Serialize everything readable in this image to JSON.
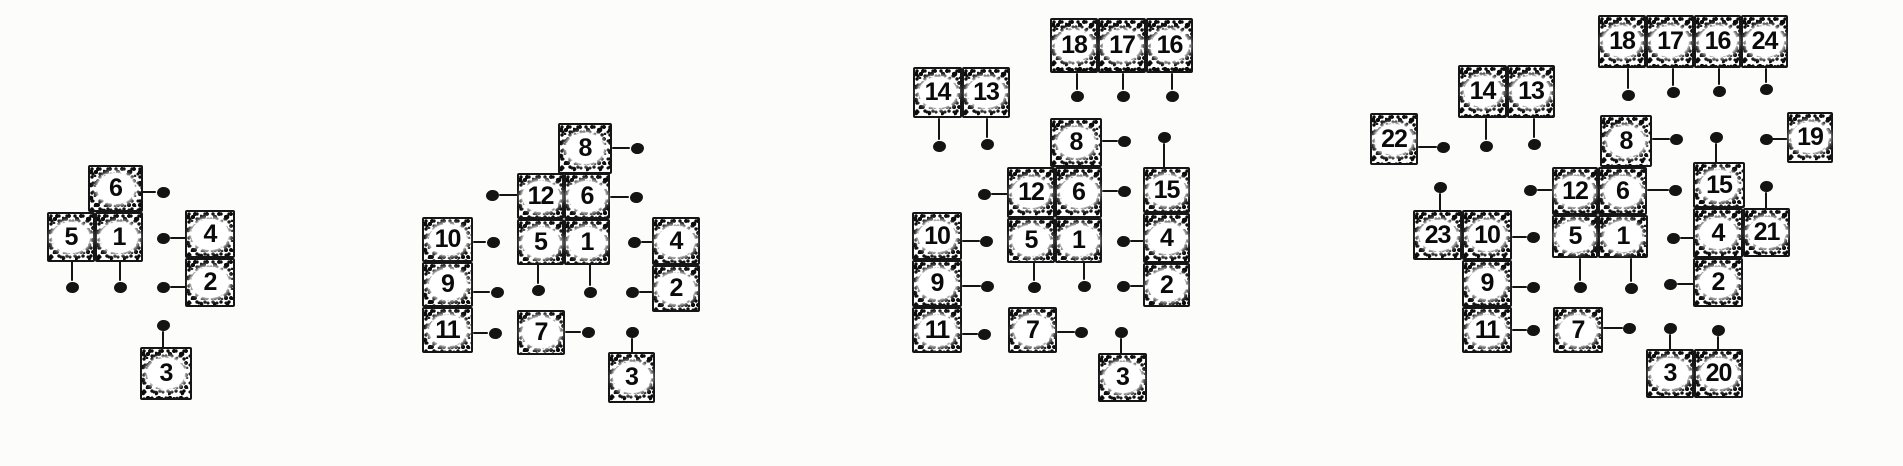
{
  "colors": {
    "ink": "#141414",
    "paper": "#fcfcfb",
    "badge_fill": "#ffffff"
  },
  "panels": [
    {
      "stage": 1,
      "unit_numbers": [
        "1",
        "2",
        "3",
        "4",
        "5",
        "6"
      ],
      "cells": [
        {
          "n": "6",
          "x": 88,
          "y": 165,
          "w": 55,
          "h": 47
        },
        {
          "n": "5",
          "x": 47,
          "y": 212,
          "w": 48,
          "h": 50
        },
        {
          "n": "1",
          "x": 95,
          "y": 212,
          "w": 48,
          "h": 50
        },
        {
          "n": "4",
          "x": 185,
          "y": 210,
          "w": 50,
          "h": 48
        },
        {
          "n": "2",
          "x": 185,
          "y": 258,
          "w": 50,
          "h": 49
        },
        {
          "n": "3",
          "x": 140,
          "y": 347,
          "w": 52,
          "h": 53
        }
      ],
      "dots": [
        {
          "x": 163,
          "y": 192
        },
        {
          "x": 163,
          "y": 238
        },
        {
          "x": 72,
          "y": 287
        },
        {
          "x": 120,
          "y": 287
        },
        {
          "x": 163,
          "y": 287
        },
        {
          "x": 163,
          "y": 325
        }
      ],
      "lines": [
        {
          "x1": 141,
          "y1": 192,
          "x2": 156,
          "y2": 192
        },
        {
          "x1": 170,
          "y1": 238,
          "x2": 187,
          "y2": 238
        },
        {
          "x1": 72,
          "y1": 256,
          "x2": 72,
          "y2": 281
        },
        {
          "x1": 120,
          "y1": 256,
          "x2": 120,
          "y2": 281
        },
        {
          "x1": 170,
          "y1": 287,
          "x2": 187,
          "y2": 287
        },
        {
          "x1": 163,
          "y1": 331,
          "x2": 163,
          "y2": 349
        }
      ]
    },
    {
      "stage": 2,
      "unit_numbers": [
        "1",
        "2",
        "3",
        "4",
        "5",
        "6",
        "7",
        "8",
        "9",
        "10",
        "11",
        "12"
      ],
      "cells": [
        {
          "n": "8",
          "x": 558,
          "y": 123,
          "w": 54,
          "h": 51
        },
        {
          "n": "12",
          "x": 517,
          "y": 173,
          "w": 47,
          "h": 46
        },
        {
          "n": "6",
          "x": 564,
          "y": 173,
          "w": 46,
          "h": 46
        },
        {
          "n": "5",
          "x": 517,
          "y": 219,
          "w": 47,
          "h": 46
        },
        {
          "n": "1",
          "x": 564,
          "y": 219,
          "w": 46,
          "h": 46
        },
        {
          "n": "10",
          "x": 422,
          "y": 217,
          "w": 51,
          "h": 45
        },
        {
          "n": "9",
          "x": 422,
          "y": 262,
          "w": 51,
          "h": 45
        },
        {
          "n": "11",
          "x": 422,
          "y": 307,
          "w": 51,
          "h": 46
        },
        {
          "n": "4",
          "x": 652,
          "y": 217,
          "w": 48,
          "h": 48
        },
        {
          "n": "2",
          "x": 652,
          "y": 265,
          "w": 48,
          "h": 47
        },
        {
          "n": "7",
          "x": 517,
          "y": 310,
          "w": 48,
          "h": 45
        },
        {
          "n": "3",
          "x": 608,
          "y": 352,
          "w": 47,
          "h": 51
        }
      ],
      "dots": [
        {
          "x": 637,
          "y": 148
        },
        {
          "x": 492,
          "y": 195
        },
        {
          "x": 636,
          "y": 197
        },
        {
          "x": 493,
          "y": 242
        },
        {
          "x": 634,
          "y": 242
        },
        {
          "x": 497,
          "y": 292
        },
        {
          "x": 538,
          "y": 290
        },
        {
          "x": 590,
          "y": 292
        },
        {
          "x": 632,
          "y": 292
        },
        {
          "x": 495,
          "y": 333
        },
        {
          "x": 588,
          "y": 332
        },
        {
          "x": 632,
          "y": 332
        }
      ],
      "lines": [
        {
          "x1": 612,
          "y1": 148,
          "x2": 630,
          "y2": 148
        },
        {
          "x1": 499,
          "y1": 195,
          "x2": 519,
          "y2": 195
        },
        {
          "x1": 610,
          "y1": 197,
          "x2": 629,
          "y2": 197
        },
        {
          "x1": 473,
          "y1": 242,
          "x2": 486,
          "y2": 242
        },
        {
          "x1": 641,
          "y1": 242,
          "x2": 654,
          "y2": 242
        },
        {
          "x1": 473,
          "y1": 292,
          "x2": 490,
          "y2": 292
        },
        {
          "x1": 538,
          "y1": 263,
          "x2": 538,
          "y2": 284
        },
        {
          "x1": 590,
          "y1": 263,
          "x2": 590,
          "y2": 286
        },
        {
          "x1": 639,
          "y1": 292,
          "x2": 654,
          "y2": 292
        },
        {
          "x1": 473,
          "y1": 333,
          "x2": 488,
          "y2": 333
        },
        {
          "x1": 565,
          "y1": 332,
          "x2": 581,
          "y2": 332
        },
        {
          "x1": 632,
          "y1": 338,
          "x2": 632,
          "y2": 354
        }
      ]
    },
    {
      "stage": 3,
      "unit_numbers": [
        "1",
        "2",
        "3",
        "4",
        "5",
        "6",
        "7",
        "8",
        "9",
        "10",
        "11",
        "12",
        "13",
        "14",
        "15",
        "16",
        "17",
        "18"
      ],
      "cells": [
        {
          "n": "18",
          "x": 1050,
          "y": 18,
          "w": 48,
          "h": 55
        },
        {
          "n": "17",
          "x": 1098,
          "y": 18,
          "w": 48,
          "h": 55
        },
        {
          "n": "16",
          "x": 1146,
          "y": 18,
          "w": 47,
          "h": 55
        },
        {
          "n": "14",
          "x": 913,
          "y": 67,
          "w": 49,
          "h": 51
        },
        {
          "n": "13",
          "x": 962,
          "y": 67,
          "w": 48,
          "h": 51
        },
        {
          "n": "8",
          "x": 1050,
          "y": 118,
          "w": 52,
          "h": 49
        },
        {
          "n": "12",
          "x": 1007,
          "y": 167,
          "w": 48,
          "h": 51
        },
        {
          "n": "6",
          "x": 1055,
          "y": 167,
          "w": 47,
          "h": 51
        },
        {
          "n": "5",
          "x": 1007,
          "y": 218,
          "w": 48,
          "h": 45
        },
        {
          "n": "1",
          "x": 1055,
          "y": 218,
          "w": 47,
          "h": 45
        },
        {
          "n": "15",
          "x": 1143,
          "y": 167,
          "w": 47,
          "h": 46
        },
        {
          "n": "4",
          "x": 1143,
          "y": 213,
          "w": 47,
          "h": 50
        },
        {
          "n": "2",
          "x": 1143,
          "y": 263,
          "w": 47,
          "h": 44
        },
        {
          "n": "10",
          "x": 912,
          "y": 212,
          "w": 50,
          "h": 48
        },
        {
          "n": "9",
          "x": 912,
          "y": 260,
          "w": 50,
          "h": 47
        },
        {
          "n": "11",
          "x": 912,
          "y": 307,
          "w": 50,
          "h": 46
        },
        {
          "n": "7",
          "x": 1008,
          "y": 307,
          "w": 49,
          "h": 46
        },
        {
          "n": "3",
          "x": 1098,
          "y": 353,
          "w": 49,
          "h": 49
        }
      ],
      "dots": [
        {
          "x": 939,
          "y": 146
        },
        {
          "x": 987,
          "y": 144
        },
        {
          "x": 1077,
          "y": 96
        },
        {
          "x": 1123,
          "y": 96
        },
        {
          "x": 1172,
          "y": 96
        },
        {
          "x": 1124,
          "y": 141
        },
        {
          "x": 1164,
          "y": 137
        },
        {
          "x": 984,
          "y": 194
        },
        {
          "x": 1124,
          "y": 191
        },
        {
          "x": 986,
          "y": 241
        },
        {
          "x": 1123,
          "y": 241
        },
        {
          "x": 987,
          "y": 286
        },
        {
          "x": 1034,
          "y": 287
        },
        {
          "x": 1084,
          "y": 286
        },
        {
          "x": 1123,
          "y": 286
        },
        {
          "x": 984,
          "y": 334
        },
        {
          "x": 1081,
          "y": 332
        },
        {
          "x": 1121,
          "y": 332
        }
      ],
      "lines": [
        {
          "x1": 939,
          "y1": 118,
          "x2": 939,
          "y2": 140
        },
        {
          "x1": 987,
          "y1": 118,
          "x2": 987,
          "y2": 138
        },
        {
          "x1": 1077,
          "y1": 73,
          "x2": 1077,
          "y2": 90
        },
        {
          "x1": 1123,
          "y1": 73,
          "x2": 1123,
          "y2": 90
        },
        {
          "x1": 1172,
          "y1": 73,
          "x2": 1172,
          "y2": 90
        },
        {
          "x1": 1102,
          "y1": 141,
          "x2": 1118,
          "y2": 141
        },
        {
          "x1": 1164,
          "y1": 143,
          "x2": 1164,
          "y2": 168
        },
        {
          "x1": 991,
          "y1": 194,
          "x2": 1009,
          "y2": 194
        },
        {
          "x1": 1102,
          "y1": 191,
          "x2": 1118,
          "y2": 191
        },
        {
          "x1": 962,
          "y1": 241,
          "x2": 980,
          "y2": 241
        },
        {
          "x1": 1130,
          "y1": 241,
          "x2": 1145,
          "y2": 241
        },
        {
          "x1": 962,
          "y1": 286,
          "x2": 981,
          "y2": 286
        },
        {
          "x1": 1034,
          "y1": 261,
          "x2": 1034,
          "y2": 281
        },
        {
          "x1": 1084,
          "y1": 261,
          "x2": 1084,
          "y2": 280
        },
        {
          "x1": 1130,
          "y1": 286,
          "x2": 1145,
          "y2": 286
        },
        {
          "x1": 962,
          "y1": 334,
          "x2": 978,
          "y2": 334
        },
        {
          "x1": 1057,
          "y1": 332,
          "x2": 1075,
          "y2": 332
        },
        {
          "x1": 1121,
          "y1": 338,
          "x2": 1121,
          "y2": 355
        }
      ]
    },
    {
      "stage": 4,
      "unit_numbers": [
        "1",
        "2",
        "3",
        "4",
        "5",
        "6",
        "7",
        "8",
        "9",
        "10",
        "11",
        "12",
        "13",
        "14",
        "15",
        "16",
        "17",
        "18",
        "19",
        "20",
        "21",
        "22",
        "23",
        "24"
      ],
      "cells": [
        {
          "n": "18",
          "x": 1598,
          "y": 15,
          "w": 48,
          "h": 53
        },
        {
          "n": "17",
          "x": 1646,
          "y": 15,
          "w": 48,
          "h": 53
        },
        {
          "n": "16",
          "x": 1694,
          "y": 15,
          "w": 47,
          "h": 53
        },
        {
          "n": "24",
          "x": 1741,
          "y": 15,
          "w": 47,
          "h": 53
        },
        {
          "n": "14",
          "x": 1458,
          "y": 65,
          "w": 49,
          "h": 53
        },
        {
          "n": "13",
          "x": 1507,
          "y": 65,
          "w": 48,
          "h": 53
        },
        {
          "n": "22",
          "x": 1370,
          "y": 113,
          "w": 48,
          "h": 52
        },
        {
          "n": "8",
          "x": 1600,
          "y": 115,
          "w": 52,
          "h": 52
        },
        {
          "n": "19",
          "x": 1787,
          "y": 112,
          "w": 46,
          "h": 51
        },
        {
          "n": "12",
          "x": 1552,
          "y": 167,
          "w": 46,
          "h": 48
        },
        {
          "n": "6",
          "x": 1598,
          "y": 167,
          "w": 49,
          "h": 48
        },
        {
          "n": "15",
          "x": 1693,
          "y": 162,
          "w": 52,
          "h": 46
        },
        {
          "n": "23",
          "x": 1413,
          "y": 210,
          "w": 49,
          "h": 50
        },
        {
          "n": "10",
          "x": 1462,
          "y": 210,
          "w": 50,
          "h": 50
        },
        {
          "n": "5",
          "x": 1552,
          "y": 215,
          "w": 46,
          "h": 43
        },
        {
          "n": "1",
          "x": 1598,
          "y": 215,
          "w": 50,
          "h": 43
        },
        {
          "n": "4",
          "x": 1693,
          "y": 208,
          "w": 50,
          "h": 50
        },
        {
          "n": "21",
          "x": 1743,
          "y": 208,
          "w": 47,
          "h": 49
        },
        {
          "n": "2",
          "x": 1693,
          "y": 258,
          "w": 50,
          "h": 49
        },
        {
          "n": "9",
          "x": 1462,
          "y": 260,
          "w": 50,
          "h": 47
        },
        {
          "n": "11",
          "x": 1462,
          "y": 307,
          "w": 50,
          "h": 46
        },
        {
          "n": "7",
          "x": 1553,
          "y": 307,
          "w": 50,
          "h": 46
        },
        {
          "n": "3",
          "x": 1646,
          "y": 349,
          "w": 48,
          "h": 49
        },
        {
          "n": "20",
          "x": 1694,
          "y": 349,
          "w": 49,
          "h": 49
        }
      ],
      "dots": [
        {
          "x": 1486,
          "y": 146
        },
        {
          "x": 1534,
          "y": 144
        },
        {
          "x": 1443,
          "y": 147
        },
        {
          "x": 1628,
          "y": 95
        },
        {
          "x": 1673,
          "y": 92
        },
        {
          "x": 1719,
          "y": 91
        },
        {
          "x": 1766,
          "y": 89
        },
        {
          "x": 1676,
          "y": 139
        },
        {
          "x": 1716,
          "y": 137
        },
        {
          "x": 1766,
          "y": 139
        },
        {
          "x": 1530,
          "y": 190
        },
        {
          "x": 1675,
          "y": 190
        },
        {
          "x": 1440,
          "y": 187
        },
        {
          "x": 1766,
          "y": 186
        },
        {
          "x": 1533,
          "y": 237
        },
        {
          "x": 1673,
          "y": 238
        },
        {
          "x": 1533,
          "y": 287
        },
        {
          "x": 1580,
          "y": 287
        },
        {
          "x": 1631,
          "y": 288
        },
        {
          "x": 1670,
          "y": 284
        },
        {
          "x": 1533,
          "y": 330
        },
        {
          "x": 1629,
          "y": 328
        },
        {
          "x": 1670,
          "y": 328
        },
        {
          "x": 1718,
          "y": 330
        }
      ],
      "lines": [
        {
          "x1": 1486,
          "y1": 118,
          "x2": 1486,
          "y2": 140
        },
        {
          "x1": 1534,
          "y1": 118,
          "x2": 1534,
          "y2": 138
        },
        {
          "x1": 1418,
          "y1": 147,
          "x2": 1437,
          "y2": 147
        },
        {
          "x1": 1628,
          "y1": 68,
          "x2": 1628,
          "y2": 89
        },
        {
          "x1": 1673,
          "y1": 68,
          "x2": 1673,
          "y2": 86
        },
        {
          "x1": 1719,
          "y1": 68,
          "x2": 1719,
          "y2": 85
        },
        {
          "x1": 1766,
          "y1": 68,
          "x2": 1766,
          "y2": 83
        },
        {
          "x1": 1652,
          "y1": 139,
          "x2": 1670,
          "y2": 139
        },
        {
          "x1": 1716,
          "y1": 143,
          "x2": 1716,
          "y2": 164
        },
        {
          "x1": 1772,
          "y1": 139,
          "x2": 1789,
          "y2": 139
        },
        {
          "x1": 1537,
          "y1": 190,
          "x2": 1554,
          "y2": 190
        },
        {
          "x1": 1647,
          "y1": 190,
          "x2": 1669,
          "y2": 190
        },
        {
          "x1": 1440,
          "y1": 193,
          "x2": 1440,
          "y2": 212
        },
        {
          "x1": 1766,
          "y1": 192,
          "x2": 1766,
          "y2": 210
        },
        {
          "x1": 1512,
          "y1": 237,
          "x2": 1527,
          "y2": 237
        },
        {
          "x1": 1680,
          "y1": 238,
          "x2": 1695,
          "y2": 238
        },
        {
          "x1": 1512,
          "y1": 287,
          "x2": 1527,
          "y2": 287
        },
        {
          "x1": 1580,
          "y1": 258,
          "x2": 1580,
          "y2": 281
        },
        {
          "x1": 1631,
          "y1": 258,
          "x2": 1631,
          "y2": 282
        },
        {
          "x1": 1677,
          "y1": 284,
          "x2": 1695,
          "y2": 284
        },
        {
          "x1": 1512,
          "y1": 330,
          "x2": 1527,
          "y2": 330
        },
        {
          "x1": 1603,
          "y1": 328,
          "x2": 1623,
          "y2": 328
        },
        {
          "x1": 1670,
          "y1": 334,
          "x2": 1670,
          "y2": 351
        },
        {
          "x1": 1718,
          "y1": 336,
          "x2": 1718,
          "y2": 351
        }
      ]
    }
  ]
}
